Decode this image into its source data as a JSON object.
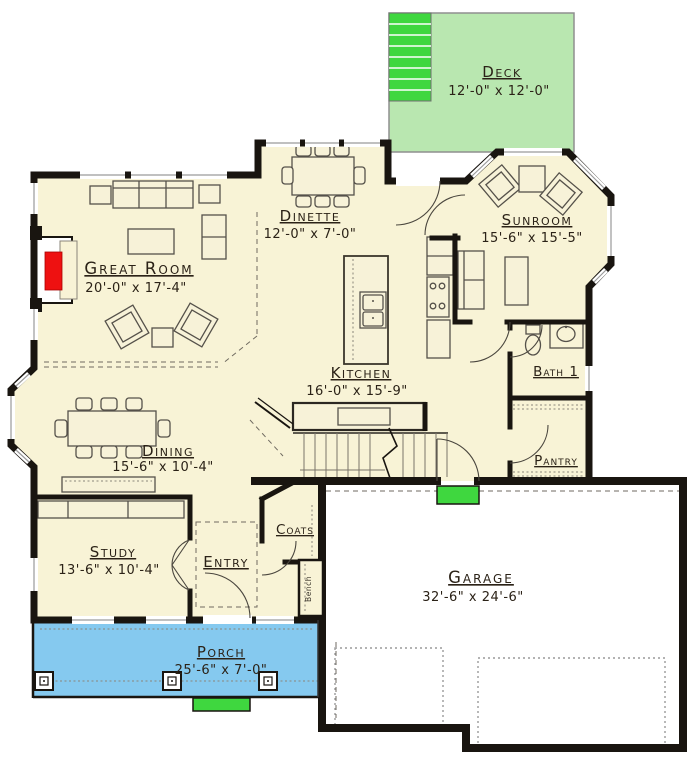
{
  "rooms": {
    "deck": {
      "name": "Deck",
      "dims": "12'-0\" x 12'-0\""
    },
    "great_room": {
      "name": "Great Room",
      "dims": "20'-0\" x 17'-4\""
    },
    "dinette": {
      "name": "Dinette",
      "dims": "12'-0\" x 7'-0\""
    },
    "sunroom": {
      "name": "Sunroom",
      "dims": "15'-6\" x 15'-5\""
    },
    "kitchen": {
      "name": "Kitchen",
      "dims": "16'-0\" x 15'-9\""
    },
    "dining": {
      "name": "Dining",
      "dims": "15'-6\" x 10'-4\""
    },
    "bath": {
      "name": "Bath 1"
    },
    "pantry": {
      "name": "Pantry"
    },
    "study": {
      "name": "Study",
      "dims": "13'-6\" x 10'-4\""
    },
    "entry": {
      "name": "Entry"
    },
    "coats": {
      "name": "Coats"
    },
    "bench": {
      "name": "Bench"
    },
    "garage": {
      "name": "Garage",
      "dims": "32'-6\" x 24'-6\""
    },
    "porch": {
      "name": "Porch",
      "dims": "25'-6\" x 7'-0\""
    }
  },
  "colors": {
    "floor": "#f8f3d6",
    "deck": "#b9e7b0",
    "step_green": "#3fd73f",
    "porch": "#85c9ef",
    "wall": "#191510",
    "fireplace": "#ee1111",
    "garage_floor": "#ffffff"
  }
}
